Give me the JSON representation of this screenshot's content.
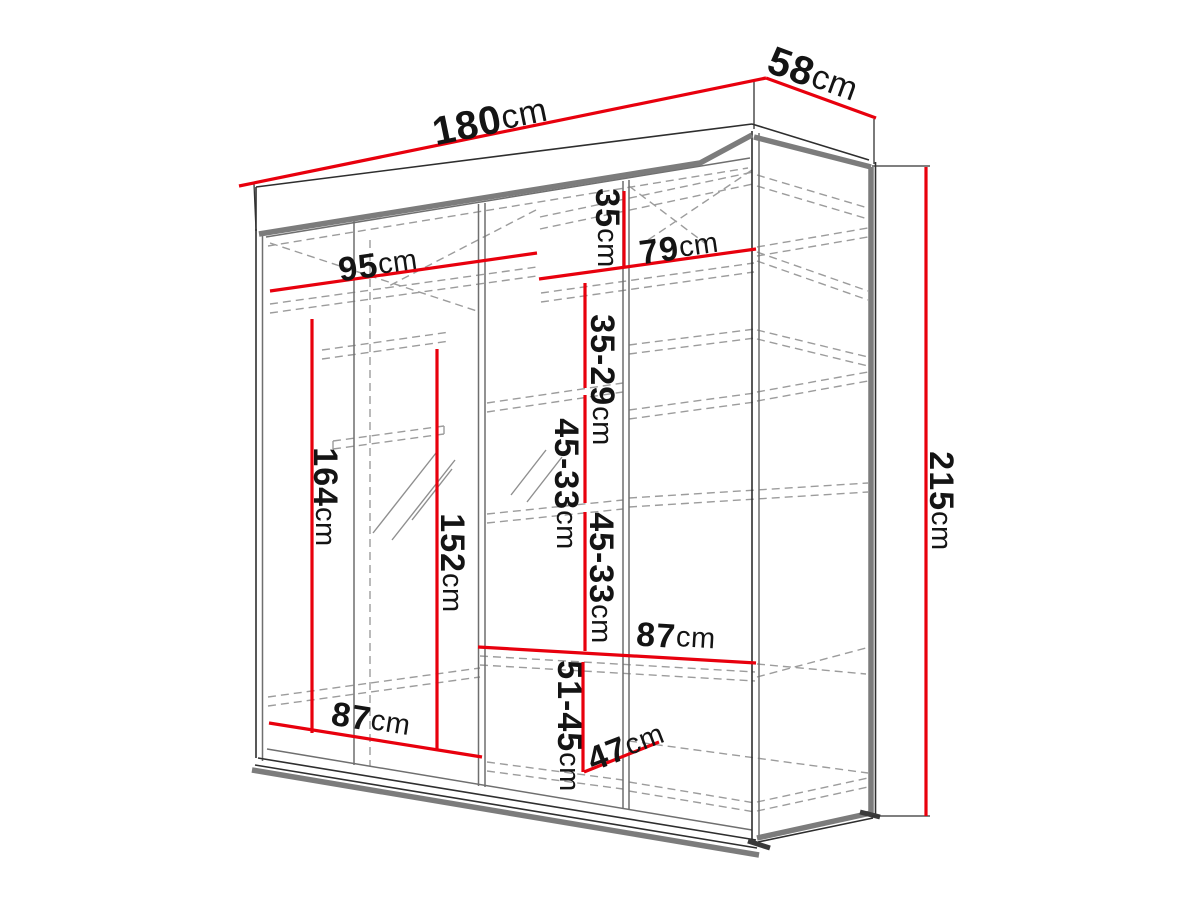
{
  "diagram_title": "wardrobe-dimension-diagram",
  "unit": "cm",
  "colors": {
    "dimension": "#e8000d",
    "edge": "#7c7c7c",
    "outline": "#2e2e2e",
    "panel": "#6f6f6f",
    "hidden": "#9c9c9c",
    "mirror": "#8f8f8f",
    "extension": "#333333",
    "text": "#141414",
    "background": "#ffffff"
  },
  "labels": {
    "width_total": {
      "value": "180",
      "unit": "cm"
    },
    "depth_total": {
      "value": "58",
      "unit": "cm"
    },
    "left_section_width": {
      "value": "95",
      "unit": "cm"
    },
    "right_section_width": {
      "value": "79",
      "unit": "cm"
    },
    "top_shelf_height": {
      "value": "35",
      "unit": "cm"
    },
    "shelf_gap_upper": {
      "value": "35-29",
      "unit": "cm"
    },
    "shelf_gap_middle": {
      "value": "45-33",
      "unit": "cm"
    },
    "shelf_gap_lower": {
      "value": "45-33",
      "unit": "cm"
    },
    "left_interior_height": {
      "value": "164",
      "unit": "cm"
    },
    "mirror_height": {
      "value": "152",
      "unit": "cm"
    },
    "total_height": {
      "value": "215",
      "unit": "cm"
    },
    "right_shelf_width": {
      "value": "87",
      "unit": "cm"
    },
    "bottom_shelf_width": {
      "value": "87",
      "unit": "cm"
    },
    "bottom_gap_height": {
      "value": "51-45",
      "unit": "cm"
    },
    "bottom_shelf_depth": {
      "value": "47",
      "unit": "cm"
    }
  }
}
